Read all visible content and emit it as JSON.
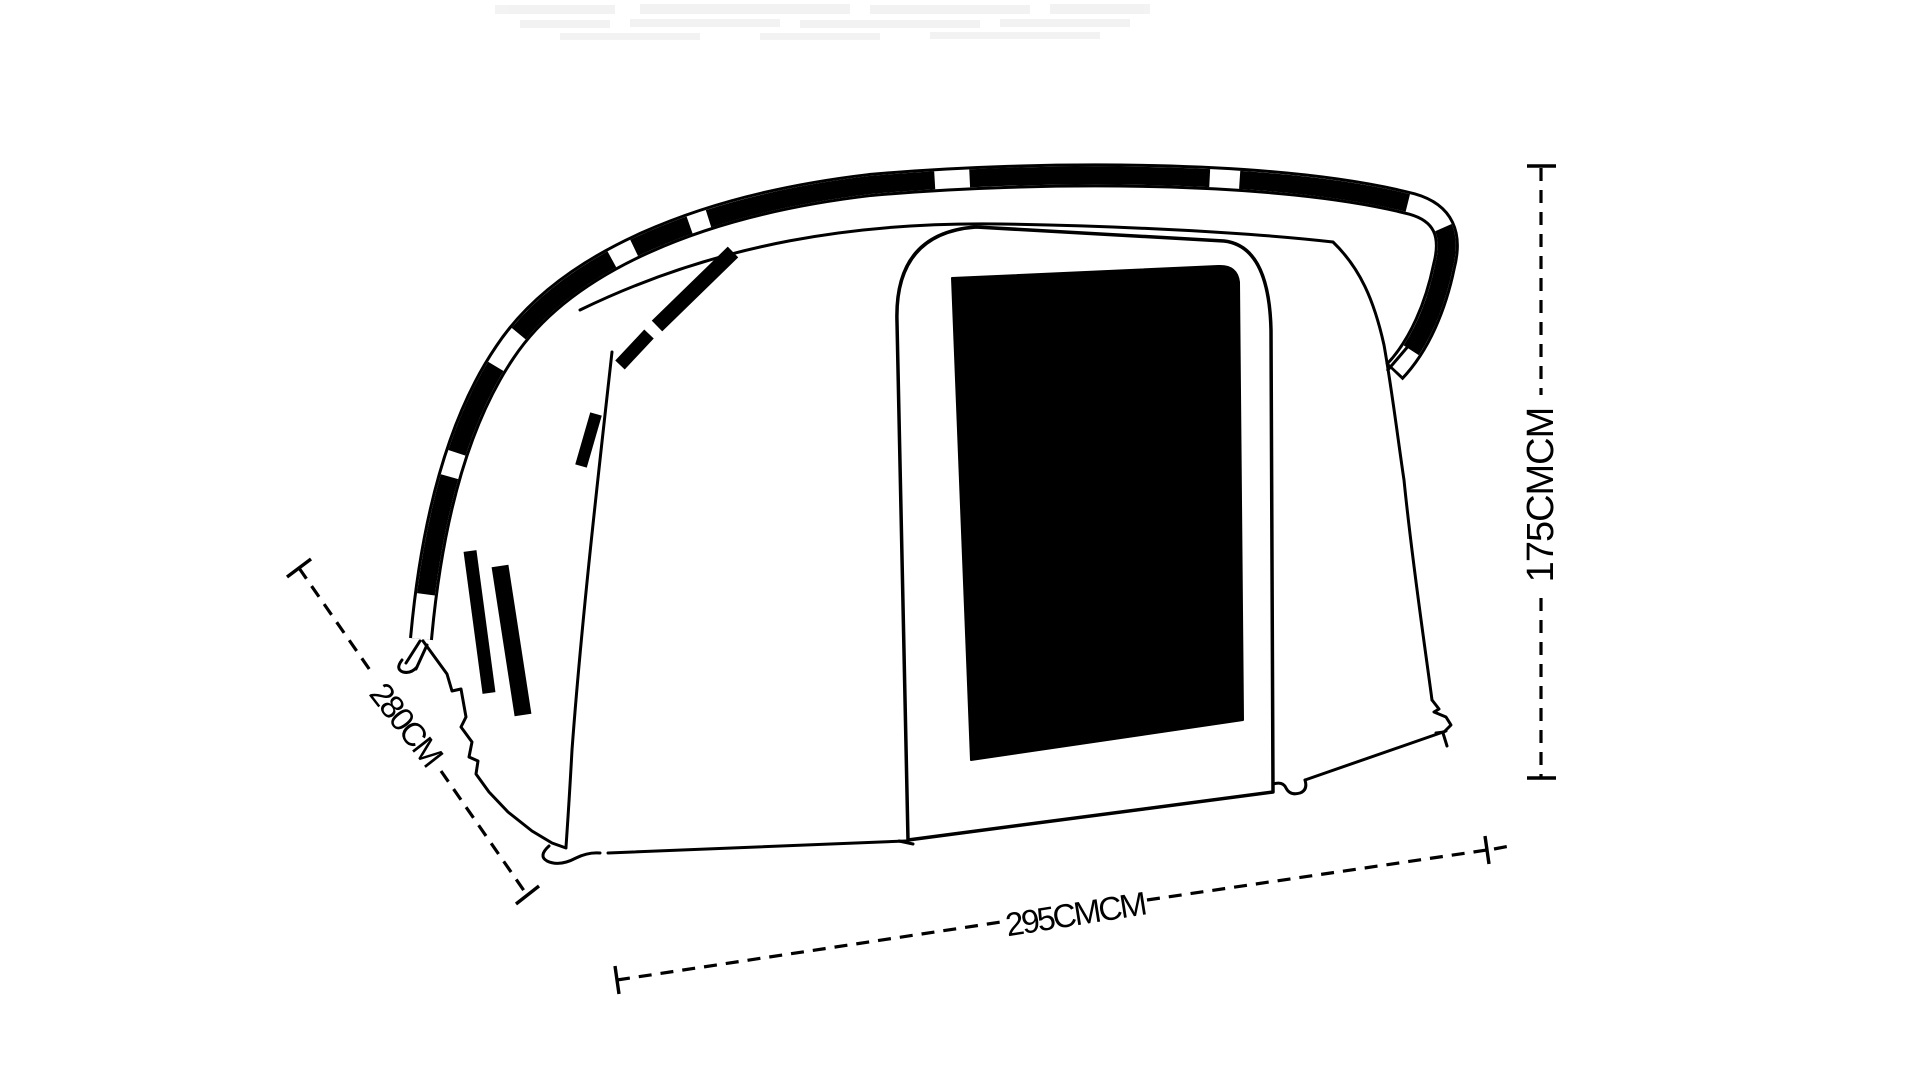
{
  "diagram": {
    "background_color": "#ffffff",
    "ink_color": "#000000",
    "dimensions": {
      "depth": {
        "label": "280CM"
      },
      "height": {
        "label": "175CMCM"
      },
      "width": {
        "label": "295CMCM"
      }
    }
  }
}
